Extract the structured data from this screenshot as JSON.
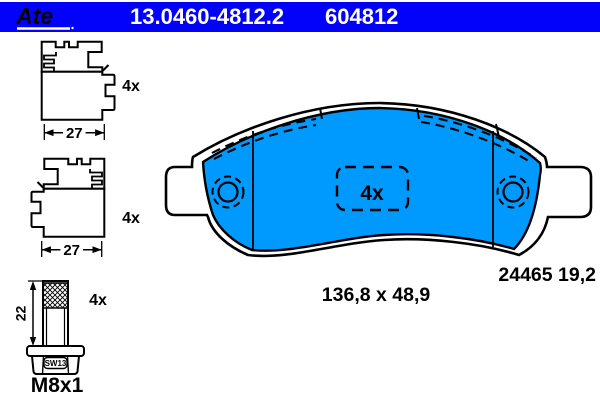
{
  "header": {
    "brand": "Ate",
    "part_number": "13.0460-4812.2",
    "ref_number": "604812"
  },
  "colors": {
    "header_bg": "#0202fa",
    "pad_fill": "#0099fe",
    "line_color": "#000000",
    "text_on_header": "#ffffff"
  },
  "accessories": {
    "clip_top": {
      "qty": "4x",
      "width_mm": "27"
    },
    "clip_bottom": {
      "qty": "4x",
      "width_mm": "27"
    },
    "bolt": {
      "qty": "4x",
      "length_mm": "22",
      "wrench_size": "SW13",
      "thread": "M8x1"
    }
  },
  "pad": {
    "qty": "4x",
    "size_label": "136,8 x 48,9",
    "drawing_ref": "24465 19,2"
  }
}
